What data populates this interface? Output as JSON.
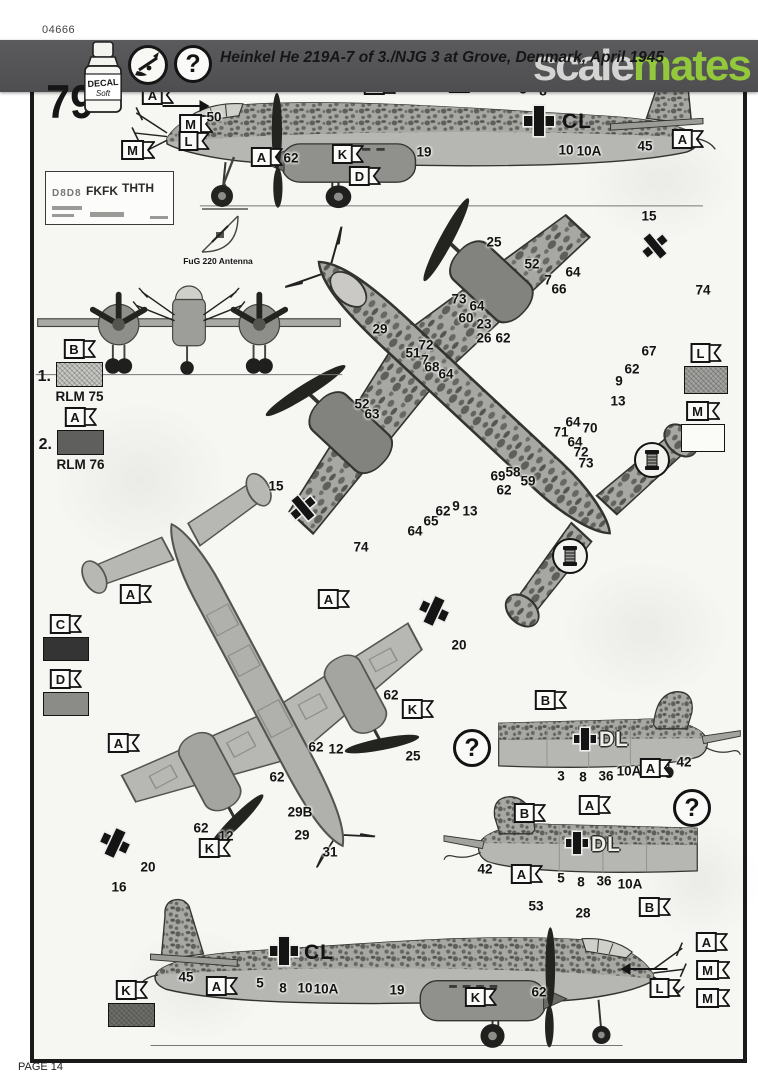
{
  "scan": {
    "kit_number": "04666",
    "watermark_scale": "scale",
    "watermark_mates": "mates",
    "page_label": "PAGE 14"
  },
  "header": {
    "step_number": "79",
    "decal_label": "DECAL",
    "decal_sub": "Soft",
    "title": "Heinkel He 219A-7 of 3./NJG 3 at Grove, Denmark, April 1945"
  },
  "symbols": {
    "question": "?"
  },
  "colors": {
    "banner": "#525254",
    "watermark_green": "#93c83c",
    "camouflage_base": "#a7a7a3",
    "camouflage_mottle": "#5e5e5a",
    "underside": "#b6b6b2",
    "ink": "#141414"
  },
  "paint_guide": {
    "fug_label": "FuG 220 Antenna",
    "swatches": [
      {
        "index": "1.",
        "flag": "B",
        "name": "RLM 75",
        "x": 56,
        "y": 362,
        "w": 47,
        "h": 25,
        "fill": "#c7c7c4",
        "hatch": true
      },
      {
        "index": "2.",
        "flag": "A",
        "name": "RLM 76",
        "x": 57,
        "y": 430,
        "w": 47,
        "h": 25,
        "fill": "#5f5f5d",
        "hatch": false
      },
      {
        "flag": "C",
        "x": 43,
        "y": 637,
        "w": 46,
        "h": 24,
        "fill": "#343435",
        "hatch": false
      },
      {
        "flag": "D",
        "x": 43,
        "y": 692,
        "w": 46,
        "h": 24,
        "fill": "#8b8b88",
        "hatch": false
      },
      {
        "flag": "L",
        "x": 684,
        "y": 366,
        "w": 44,
        "h": 28,
        "fill": "#a3a3a0",
        "hatch": true
      },
      {
        "flag": "M",
        "x": 681,
        "y": 424,
        "w": 44,
        "h": 28,
        "fill": "#fbfbf8",
        "hatch": false
      },
      {
        "flag": "K",
        "x": 108,
        "y": 1003,
        "w": 47,
        "h": 24,
        "fill": "#6d6d6a",
        "hatch": true
      }
    ]
  },
  "decal_sheet": {
    "codes": [
      "D8D8",
      "FKFK",
      "THTH"
    ]
  },
  "annotations": [
    {
      "k": "flag",
      "t": "A",
      "x": 158,
      "y": 95
    },
    {
      "k": "arrow",
      "dir": "right",
      "x": 186,
      "y": 106,
      "len": 46
    },
    {
      "k": "flag",
      "t": "M",
      "x": 196,
      "y": 124
    },
    {
      "k": "flag",
      "t": "L",
      "x": 194,
      "y": 141
    },
    {
      "k": "flag",
      "t": "M",
      "x": 138,
      "y": 150
    },
    {
      "k": "num",
      "t": "50",
      "x": 214,
      "y": 117
    },
    {
      "k": "num",
      "t": "27",
      "x": 239,
      "y": 84
    },
    {
      "k": "num",
      "t": "43",
      "x": 253,
      "y": 69
    },
    {
      "k": "num",
      "t": "35",
      "x": 268,
      "y": 76
    },
    {
      "k": "num",
      "t": "49",
      "x": 297,
      "y": 73
    },
    {
      "k": "flag",
      "t": "A",
      "x": 380,
      "y": 85
    },
    {
      "k": "flag",
      "t": "B",
      "x": 465,
      "y": 83
    },
    {
      "k": "num",
      "t": "3",
      "x": 523,
      "y": 89
    },
    {
      "k": "num",
      "t": "8",
      "x": 543,
      "y": 91
    },
    {
      "k": "cross",
      "x": 539,
      "y": 121,
      "s": 30
    },
    {
      "k": "code",
      "t": "CL",
      "x": 577,
      "y": 122,
      "st": "solid"
    },
    {
      "k": "num",
      "t": "10",
      "x": 566,
      "y": 150
    },
    {
      "k": "num",
      "t": "10A",
      "x": 589,
      "y": 151
    },
    {
      "k": "num",
      "t": "45",
      "x": 645,
      "y": 146
    },
    {
      "k": "flag",
      "t": "B",
      "x": 686,
      "y": 71
    },
    {
      "k": "flag",
      "t": "A",
      "x": 688,
      "y": 139
    },
    {
      "k": "flag",
      "t": "A",
      "x": 267,
      "y": 157
    },
    {
      "k": "num",
      "t": "62",
      "x": 291,
      "y": 158
    },
    {
      "k": "flag",
      "t": "K",
      "x": 348,
      "y": 154
    },
    {
      "k": "flag",
      "t": "D",
      "x": 365,
      "y": 176
    },
    {
      "k": "num",
      "t": "19",
      "x": 424,
      "y": 152
    },
    {
      "k": "num",
      "t": "25",
      "x": 494,
      "y": 242
    },
    {
      "k": "num",
      "t": "52",
      "x": 532,
      "y": 264
    },
    {
      "k": "num",
      "t": "7",
      "x": 548,
      "y": 280
    },
    {
      "k": "num",
      "t": "66",
      "x": 559,
      "y": 289
    },
    {
      "k": "num",
      "t": "64",
      "x": 573,
      "y": 272
    },
    {
      "k": "num",
      "t": "15",
      "x": 649,
      "y": 216
    },
    {
      "k": "num",
      "t": "74",
      "x": 703,
      "y": 290
    },
    {
      "k": "num",
      "t": "73",
      "x": 459,
      "y": 299
    },
    {
      "k": "num",
      "t": "64",
      "x": 477,
      "y": 306
    },
    {
      "k": "num",
      "t": "60",
      "x": 466,
      "y": 318
    },
    {
      "k": "num",
      "t": "23",
      "x": 484,
      "y": 324
    },
    {
      "k": "num",
      "t": "26",
      "x": 484,
      "y": 338
    },
    {
      "k": "num",
      "t": "62",
      "x": 503,
      "y": 338
    },
    {
      "k": "num",
      "t": "29",
      "x": 380,
      "y": 329
    },
    {
      "k": "num",
      "t": "72",
      "x": 426,
      "y": 345
    },
    {
      "k": "num",
      "t": "51",
      "x": 413,
      "y": 353
    },
    {
      "k": "num",
      "t": "7",
      "x": 425,
      "y": 360
    },
    {
      "k": "num",
      "t": "68",
      "x": 432,
      "y": 367
    },
    {
      "k": "num",
      "t": "64",
      "x": 446,
      "y": 374
    },
    {
      "k": "num",
      "t": "67",
      "x": 649,
      "y": 351
    },
    {
      "k": "num",
      "t": "62",
      "x": 632,
      "y": 369
    },
    {
      "k": "num",
      "t": "9",
      "x": 619,
      "y": 381
    },
    {
      "k": "num",
      "t": "13",
      "x": 618,
      "y": 401
    },
    {
      "k": "num",
      "t": "52",
      "x": 362,
      "y": 404
    },
    {
      "k": "num",
      "t": "63",
      "x": 372,
      "y": 414
    },
    {
      "k": "num",
      "t": "15",
      "x": 276,
      "y": 486
    },
    {
      "k": "num",
      "t": "74",
      "x": 361,
      "y": 547
    },
    {
      "k": "num",
      "t": "64",
      "x": 415,
      "y": 531
    },
    {
      "k": "num",
      "t": "65",
      "x": 431,
      "y": 521
    },
    {
      "k": "num",
      "t": "62",
      "x": 443,
      "y": 511
    },
    {
      "k": "num",
      "t": "9",
      "x": 456,
      "y": 506
    },
    {
      "k": "num",
      "t": "13",
      "x": 470,
      "y": 511
    },
    {
      "k": "num",
      "t": "69",
      "x": 498,
      "y": 476
    },
    {
      "k": "num",
      "t": "58",
      "x": 513,
      "y": 472
    },
    {
      "k": "num",
      "t": "62",
      "x": 504,
      "y": 490
    },
    {
      "k": "num",
      "t": "59",
      "x": 528,
      "y": 481
    },
    {
      "k": "num",
      "t": "71",
      "x": 561,
      "y": 432
    },
    {
      "k": "num",
      "t": "64",
      "x": 573,
      "y": 422
    },
    {
      "k": "num",
      "t": "70",
      "x": 590,
      "y": 428
    },
    {
      "k": "num",
      "t": "64",
      "x": 575,
      "y": 442
    },
    {
      "k": "num",
      "t": "72",
      "x": 581,
      "y": 452
    },
    {
      "k": "num",
      "t": "73",
      "x": 586,
      "y": 463
    },
    {
      "k": "spool",
      "x": 652,
      "y": 460
    },
    {
      "k": "spool",
      "x": 570,
      "y": 556
    },
    {
      "k": "cross",
      "x": 655,
      "y": 246,
      "s": 26,
      "rot": -40
    },
    {
      "k": "cross",
      "x": 303,
      "y": 508,
      "s": 26,
      "rot": -40
    },
    {
      "k": "flag",
      "t": "A",
      "x": 136,
      "y": 594
    },
    {
      "k": "flag",
      "t": "A",
      "x": 334,
      "y": 599
    },
    {
      "k": "num",
      "t": "20",
      "x": 459,
      "y": 645
    },
    {
      "k": "num",
      "t": "62",
      "x": 391,
      "y": 695
    },
    {
      "k": "flag",
      "t": "K",
      "x": 418,
      "y": 709
    },
    {
      "k": "flag",
      "t": "A",
      "x": 124,
      "y": 743
    },
    {
      "k": "num",
      "t": "62",
      "x": 316,
      "y": 747
    },
    {
      "k": "num",
      "t": "12",
      "x": 336,
      "y": 749
    },
    {
      "k": "num",
      "t": "25",
      "x": 413,
      "y": 756
    },
    {
      "k": "num",
      "t": "62",
      "x": 277,
      "y": 777
    },
    {
      "k": "num",
      "t": "29B",
      "x": 300,
      "y": 812
    },
    {
      "k": "num",
      "t": "29",
      "x": 302,
      "y": 835
    },
    {
      "k": "num",
      "t": "62",
      "x": 201,
      "y": 828
    },
    {
      "k": "num",
      "t": "12",
      "x": 226,
      "y": 836
    },
    {
      "k": "flag",
      "t": "K",
      "x": 215,
      "y": 848
    },
    {
      "k": "num",
      "t": "31",
      "x": 330,
      "y": 852
    },
    {
      "k": "num",
      "t": "20",
      "x": 148,
      "y": 867
    },
    {
      "k": "num",
      "t": "16",
      "x": 119,
      "y": 887
    },
    {
      "k": "cross",
      "x": 115,
      "y": 843,
      "s": 28,
      "rot": 25
    },
    {
      "k": "cross",
      "x": 434,
      "y": 611,
      "s": 28,
      "rot": 25
    },
    {
      "k": "q",
      "x": 472,
      "y": 748
    },
    {
      "k": "flag",
      "t": "B",
      "x": 551,
      "y": 700
    },
    {
      "k": "cross",
      "x": 585,
      "y": 739,
      "s": 22
    },
    {
      "k": "code",
      "t": "DL",
      "x": 614,
      "y": 740,
      "st": "outline"
    },
    {
      "k": "num",
      "t": "3",
      "x": 561,
      "y": 776
    },
    {
      "k": "num",
      "t": "8",
      "x": 583,
      "y": 777
    },
    {
      "k": "num",
      "t": "36",
      "x": 606,
      "y": 776
    },
    {
      "k": "num",
      "t": "10A",
      "x": 629,
      "y": 771
    },
    {
      "k": "flag",
      "t": "A",
      "x": 656,
      "y": 768
    },
    {
      "k": "num",
      "t": "42",
      "x": 684,
      "y": 762
    },
    {
      "k": "num",
      "t": "42",
      "x": 485,
      "y": 869
    },
    {
      "k": "flag",
      "t": "B",
      "x": 530,
      "y": 813
    },
    {
      "k": "flag",
      "t": "A",
      "x": 595,
      "y": 805
    },
    {
      "k": "cross",
      "x": 577,
      "y": 843,
      "s": 22
    },
    {
      "k": "code",
      "t": "DL",
      "x": 606,
      "y": 845,
      "st": "outline"
    },
    {
      "k": "flag",
      "t": "A",
      "x": 527,
      "y": 874
    },
    {
      "k": "num",
      "t": "5",
      "x": 561,
      "y": 878
    },
    {
      "k": "num",
      "t": "8",
      "x": 581,
      "y": 882
    },
    {
      "k": "num",
      "t": "36",
      "x": 604,
      "y": 881
    },
    {
      "k": "num",
      "t": "10A",
      "x": 630,
      "y": 884
    },
    {
      "k": "q",
      "x": 692,
      "y": 808
    },
    {
      "k": "num",
      "t": "53",
      "x": 536,
      "y": 906
    },
    {
      "k": "num",
      "t": "28",
      "x": 583,
      "y": 913
    },
    {
      "k": "flag",
      "t": "B",
      "x": 655,
      "y": 907
    },
    {
      "k": "num",
      "t": "45",
      "x": 186,
      "y": 977
    },
    {
      "k": "flag",
      "t": "A",
      "x": 222,
      "y": 986
    },
    {
      "k": "num",
      "t": "5",
      "x": 260,
      "y": 983
    },
    {
      "k": "num",
      "t": "8",
      "x": 283,
      "y": 988
    },
    {
      "k": "num",
      "t": "10",
      "x": 305,
      "y": 988
    },
    {
      "k": "num",
      "t": "10A",
      "x": 326,
      "y": 989
    },
    {
      "k": "num",
      "t": "19",
      "x": 397,
      "y": 990
    },
    {
      "k": "cross",
      "x": 284,
      "y": 951,
      "s": 28
    },
    {
      "k": "code",
      "t": "CL",
      "x": 319,
      "y": 953,
      "st": "solid"
    },
    {
      "k": "flag",
      "t": "K",
      "x": 481,
      "y": 997
    },
    {
      "k": "num",
      "t": "62",
      "x": 539,
      "y": 992
    },
    {
      "k": "arrow",
      "dir": "left",
      "x": 644,
      "y": 969,
      "len": 46
    },
    {
      "k": "flag",
      "t": "A",
      "x": 712,
      "y": 942
    },
    {
      "k": "flag",
      "t": "M",
      "x": 713,
      "y": 970
    },
    {
      "k": "flag",
      "t": "L",
      "x": 665,
      "y": 988
    },
    {
      "k": "flag",
      "t": "M",
      "x": 713,
      "y": 998
    }
  ]
}
